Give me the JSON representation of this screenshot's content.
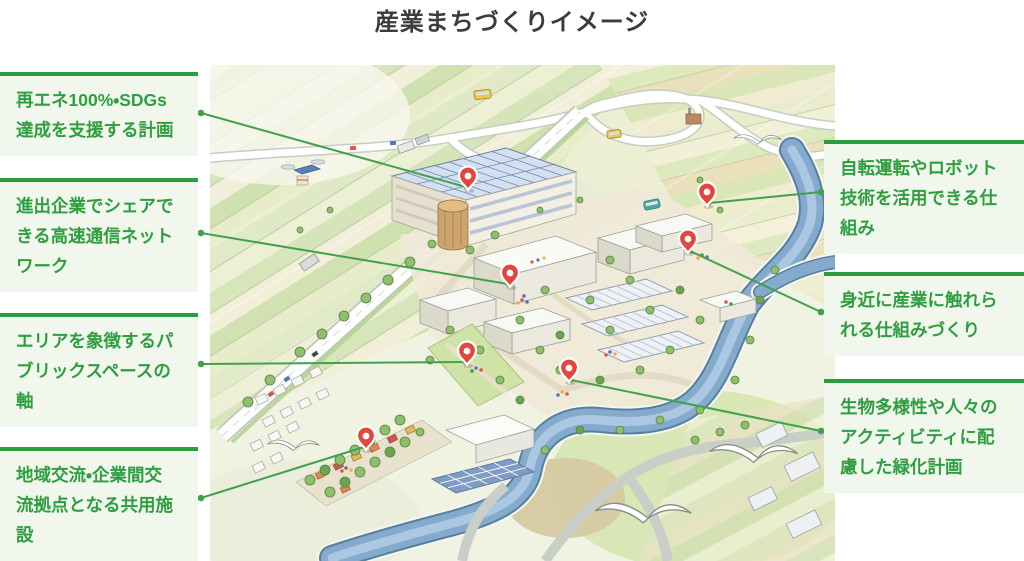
{
  "title": "産業まちづくりイメージ",
  "labels": {
    "left": [
      {
        "text": "再エネ100%・SDGs\n達成を支援する計画"
      },
      {
        "text": "進出企業でシェアで\nきる高速通信ネット\nワーク"
      },
      {
        "text": "エリアを象徴するパ\nブリックスペースの\n軸"
      },
      {
        "text": "地域交流・企業間交\n流拠点となる共用施\n設"
      }
    ],
    "right": [
      {
        "text": "自転運転やロボット\n技術を活用できる仕\n組み"
      },
      {
        "text": "身近に産業に触れら\nれる仕組みづくり"
      },
      {
        "text": "生物多様性や人々の\nアクティビティに配\n慮した緑化計画"
      }
    ]
  },
  "colors": {
    "accent_green_text": "#2f9e41",
    "label_background": "#f1f7ec",
    "label_top_border": "#2b9c3f",
    "connector_line": "#43a14c",
    "pin_red": "#e2463d",
    "title_color": "#3c3c3e",
    "river_blue": "#84abce",
    "solar_panel_blue": "#7e9cc4"
  }
}
